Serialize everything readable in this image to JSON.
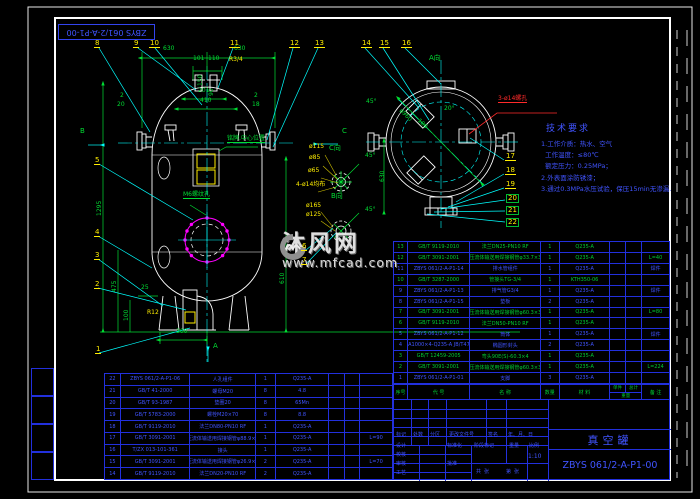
{
  "margin": {
    "drawing_no_flipped": "ZBYS 061/2-A-P1-00"
  },
  "tech_req": {
    "title": "技术要求",
    "lines": [
      "1.工作介质：热水、空气",
      "  工作温度：≤80℃",
      "  额定压力：0.25MPa；",
      "2.外表面涂防锈漆；",
      "3.通过0.3MPa水压试验，保压15min无渗漏."
    ]
  },
  "watermark": {
    "site_name": "沐风网",
    "site_url": "www.mfcad.com"
  },
  "annotations": [
    {
      "t": "630",
      "x": 163,
      "y": 52
    },
    {
      "t": "630",
      "x": 234,
      "y": 52
    },
    {
      "t": "101",
      "x": 193,
      "y": 62
    },
    {
      "t": "110",
      "x": 208,
      "y": 62
    },
    {
      "t": "R3/4",
      "x": 229,
      "y": 63,
      "c": "y"
    },
    {
      "t": "201",
      "x": 198,
      "y": 94
    },
    {
      "t": "410",
      "x": 200,
      "y": 104
    },
    {
      "t": "150",
      "x": 198,
      "y": 92,
      "r": -90
    },
    {
      "t": "90",
      "x": 209,
      "y": 102,
      "r": -90
    },
    {
      "t": "2",
      "x": 120,
      "y": 99
    },
    {
      "t": "20",
      "x": 117,
      "y": 108
    },
    {
      "t": "2",
      "x": 254,
      "y": 99
    },
    {
      "t": "18",
      "x": 252,
      "y": 108
    },
    {
      "t": "1295",
      "x": 97,
      "y": 222,
      "r": -90
    },
    {
      "t": "475",
      "x": 112,
      "y": 298,
      "r": -90
    },
    {
      "t": "100",
      "x": 124,
      "y": 327,
      "r": -90
    },
    {
      "t": "25",
      "x": 141,
      "y": 291
    },
    {
      "t": "R12",
      "x": 147,
      "y": 316,
      "c": "y"
    },
    {
      "t": "300",
      "x": 176,
      "y": 335
    },
    {
      "t": "610",
      "x": 280,
      "y": 290,
      "r": -90
    },
    {
      "t": "铭牌,中心位置",
      "x": 227,
      "y": 142,
      "u": 1
    },
    {
      "t": "M6螺纹孔",
      "x": 183,
      "y": 198,
      "u": 1
    },
    {
      "t": "A向",
      "x": 429,
      "y": 62,
      "s": 7
    },
    {
      "t": "45°",
      "x": 366,
      "y": 105
    },
    {
      "t": "20°",
      "x": 444,
      "y": 112
    },
    {
      "t": "ø960",
      "x": 402,
      "y": 114,
      "r": 45
    },
    {
      "t": "180",
      "x": 420,
      "y": 124,
      "r": 45
    },
    {
      "t": "630",
      "x": 380,
      "y": 188,
      "r": -90
    },
    {
      "t": "3-ø14螺孔",
      "x": 498,
      "y": 102,
      "c": "r",
      "u": 1
    },
    {
      "t": "C向",
      "x": 329,
      "y": 152,
      "s": 7
    },
    {
      "t": "ø115",
      "x": 309,
      "y": 150,
      "c": "y"
    },
    {
      "t": "ø85",
      "x": 309,
      "y": 161,
      "c": "y"
    },
    {
      "t": "ø65",
      "x": 308,
      "y": 174,
      "c": "y"
    },
    {
      "t": "4-ø14均布",
      "x": 296,
      "y": 188,
      "c": "y"
    },
    {
      "t": "45°",
      "x": 365,
      "y": 159
    },
    {
      "t": "B向",
      "x": 331,
      "y": 200,
      "s": 7
    },
    {
      "t": "ø165",
      "x": 306,
      "y": 209,
      "c": "y"
    },
    {
      "t": "ø125",
      "x": 306,
      "y": 218,
      "c": "y"
    },
    {
      "t": "45°",
      "x": 365,
      "y": 213
    },
    {
      "t": "B",
      "x": 80,
      "y": 135,
      "s": 7
    },
    {
      "t": "C",
      "x": 342,
      "y": 135,
      "s": 7
    },
    {
      "t": "A",
      "x": 213,
      "y": 350,
      "s": 7
    },
    {
      "t": "标记",
      "x": 396,
      "y": 438,
      "c": "b",
      "s": 5
    },
    {
      "t": "处数",
      "x": 413,
      "y": 438,
      "c": "b",
      "s": 5
    },
    {
      "t": "分区",
      "x": 430,
      "y": 438,
      "c": "b",
      "s": 5
    },
    {
      "t": "更改文件号",
      "x": 449,
      "y": 438,
      "c": "b",
      "s": 5
    },
    {
      "t": "签名",
      "x": 488,
      "y": 438,
      "c": "b",
      "s": 5
    },
    {
      "t": "年、月、日",
      "x": 508,
      "y": 438,
      "c": "b",
      "s": 5
    },
    {
      "t": "设计",
      "x": 396,
      "y": 449,
      "c": "b",
      "s": 5
    },
    {
      "t": "校核",
      "x": 396,
      "y": 458,
      "c": "b",
      "s": 5
    },
    {
      "t": "审核",
      "x": 396,
      "y": 467,
      "c": "b",
      "s": 5
    },
    {
      "t": "工艺",
      "x": 396,
      "y": 476,
      "c": "b",
      "s": 5
    },
    {
      "t": "标准化",
      "x": 447,
      "y": 449,
      "c": "b",
      "s": 5
    },
    {
      "t": "批准",
      "x": 447,
      "y": 467,
      "c": "b",
      "s": 5
    },
    {
      "t": "阶段标记",
      "x": 474,
      "y": 449,
      "c": "b",
      "s": 5
    },
    {
      "t": "重量",
      "x": 509,
      "y": 449,
      "c": "b",
      "s": 5
    },
    {
      "t": "比例",
      "x": 529,
      "y": 449,
      "c": "b",
      "s": 5
    },
    {
      "t": "1:10",
      "x": 528,
      "y": 460,
      "c": "b",
      "s": 6
    },
    {
      "t": "共  张",
      "x": 476,
      "y": 475,
      "c": "b",
      "s": 5
    },
    {
      "t": "第  张",
      "x": 506,
      "y": 475,
      "c": "b",
      "s": 5
    }
  ],
  "balloons": [
    {
      "n": "1",
      "x": 95,
      "y": 346
    },
    {
      "n": "2",
      "x": 94,
      "y": 281
    },
    {
      "n": "3",
      "x": 94,
      "y": 252
    },
    {
      "n": "4",
      "x": 94,
      "y": 229
    },
    {
      "n": "5",
      "x": 94,
      "y": 157
    },
    {
      "n": "6",
      "x": 301,
      "y": 243
    },
    {
      "n": "7",
      "x": 301,
      "y": 257
    },
    {
      "n": "8",
      "x": 94,
      "y": 40
    },
    {
      "n": "9",
      "x": 133,
      "y": 40
    },
    {
      "n": "10",
      "x": 149,
      "y": 40
    },
    {
      "n": "11",
      "x": 229,
      "y": 40
    },
    {
      "n": "12",
      "x": 289,
      "y": 40
    },
    {
      "n": "13",
      "x": 314,
      "y": 40
    },
    {
      "n": "14",
      "x": 361,
      "y": 40
    },
    {
      "n": "15",
      "x": 379,
      "y": 40
    },
    {
      "n": "16",
      "x": 401,
      "y": 40
    },
    {
      "n": "17",
      "x": 505,
      "y": 153
    },
    {
      "n": "18",
      "x": 505,
      "y": 167
    },
    {
      "n": "19",
      "x": 505,
      "y": 181
    },
    {
      "n": "20",
      "x": 506,
      "y": 194,
      "box": 1
    },
    {
      "n": "21",
      "x": 506,
      "y": 206,
      "box": 1
    },
    {
      "n": "22",
      "x": 506,
      "y": 218,
      "box": 1
    }
  ],
  "bom": {
    "header": {
      "seq": "序号",
      "code": "代  号",
      "name": "名  称",
      "qty": "数量",
      "material": "材  料",
      "unit": "单件",
      "total": "总计",
      "weight": "重量",
      "remark": "备 注"
    },
    "right_rows": [
      {
        "g": 1,
        "c": [
          "13",
          "GB/T 9119-2010",
          "法兰DN25-PN10 RF",
          "1",
          "Q235-A",
          "",
          "",
          ""
        ]
      },
      {
        "g": 1,
        "c": [
          "12",
          "GB/T 3091-2001",
          "低压流体输送用焊接钢管φ33.7×3.2",
          "1",
          "Q235-A",
          "",
          "",
          "L=40"
        ]
      },
      {
        "g": 0,
        "c": [
          "11",
          "ZBYS 061/2-A-P1-14",
          "排水管组件",
          "1",
          "Q235-A",
          "",
          "",
          "焊件"
        ]
      },
      {
        "g": 1,
        "c": [
          "10",
          "GB/T 3287-2000",
          "管接头TG-3/4",
          "1",
          "KTH350-06",
          "",
          "",
          ""
        ]
      },
      {
        "g": 0,
        "c": [
          "9",
          "ZBYS 061/2-A-P1-13",
          "排气管G3/4",
          "1",
          "Q235-A",
          "",
          "",
          "焊件"
        ]
      },
      {
        "g": 0,
        "c": [
          "8",
          "ZBYS 061/2-A-P1-15",
          "垫板",
          "2",
          "Q235-A",
          "",
          "",
          ""
        ]
      },
      {
        "g": 1,
        "c": [
          "7",
          "GB/T 3091-2001",
          "低压流体输送用焊接钢管φ60.3×3.8",
          "1",
          "Q235-A",
          "",
          "",
          "L=80"
        ]
      },
      {
        "g": 1,
        "c": [
          "6",
          "GB/T 9119-2010",
          "法兰DN50-PN10 RF",
          "1",
          "Q235-A",
          "",
          "",
          ""
        ]
      },
      {
        "g": 0,
        "c": [
          "5",
          "ZBYS 061/2-A-P1-12",
          "筒体",
          "1",
          "Q235-A",
          "",
          "",
          "焊件"
        ]
      },
      {
        "g": 0,
        "c": [
          "4",
          "EHA1000×4-Q235-A JB/T4746",
          "椭圆形封头",
          "2",
          "Q235-A",
          "",
          "",
          ""
        ]
      },
      {
        "g": 1,
        "c": [
          "3",
          "GB/T 12459-2005",
          "弯头90E(S)-60.3×4",
          "1",
          "Q235-A",
          "",
          "",
          ""
        ]
      },
      {
        "g": 1,
        "c": [
          "2",
          "GB/T 3091-2001",
          "低压流体输送用焊接钢管φ60.3×3.8",
          "1",
          "Q235-A",
          "",
          "",
          "L=224"
        ]
      },
      {
        "g": 0,
        "c": [
          "1",
          "ZBYS 061/2-A-P1-01",
          "支脚",
          "3",
          "Q235-A",
          "",
          "",
          ""
        ]
      }
    ],
    "left_rows": [
      {
        "c": [
          "22",
          "ZBYS 061/2-A-P1-06",
          "人孔组件",
          "1",
          "Q235-A",
          "",
          "",
          ""
        ]
      },
      {
        "c": [
          "21",
          "GB/T 41-2000",
          "螺母M20",
          "8",
          "4.8",
          "",
          "",
          ""
        ]
      },
      {
        "c": [
          "20",
          "GB/T 93-1987",
          "垫圈20",
          "8",
          "65Mn",
          "",
          "",
          ""
        ]
      },
      {
        "c": [
          "19",
          "GB/T 5783-2000",
          "螺栓M20×70",
          "8",
          "8.8",
          "",
          "",
          ""
        ]
      },
      {
        "c": [
          "18",
          "GB/T 9119-2010",
          "法兰DN80-PN10 RF",
          "1",
          "Q235-A",
          "",
          "",
          ""
        ]
      },
      {
        "c": [
          "17",
          "GB/T 3091-2001",
          "低压流体输送用焊接钢管φ88.9×4.5",
          "1",
          "Q235-A",
          "",
          "",
          "L=90"
        ]
      },
      {
        "c": [
          "16",
          "T/ZX 013-101-361",
          "接头",
          "1",
          "Q235-A",
          "",
          "",
          ""
        ]
      },
      {
        "c": [
          "15",
          "GB/T 3091-2001",
          "低压流体输送用焊接钢管φ26.9×2.8",
          "2",
          "Q235-A",
          "",
          "",
          "L=70"
        ]
      },
      {
        "c": [
          "14",
          "GB/T 9119-2010",
          "法兰DN20-PN10 RF",
          "2",
          "Q235-A",
          "",
          "",
          ""
        ]
      }
    ]
  },
  "title_block": {
    "product_title": "真空罐",
    "drawing_no": "ZBYS 061/2-A-P1-00",
    "scale": "1:10"
  }
}
